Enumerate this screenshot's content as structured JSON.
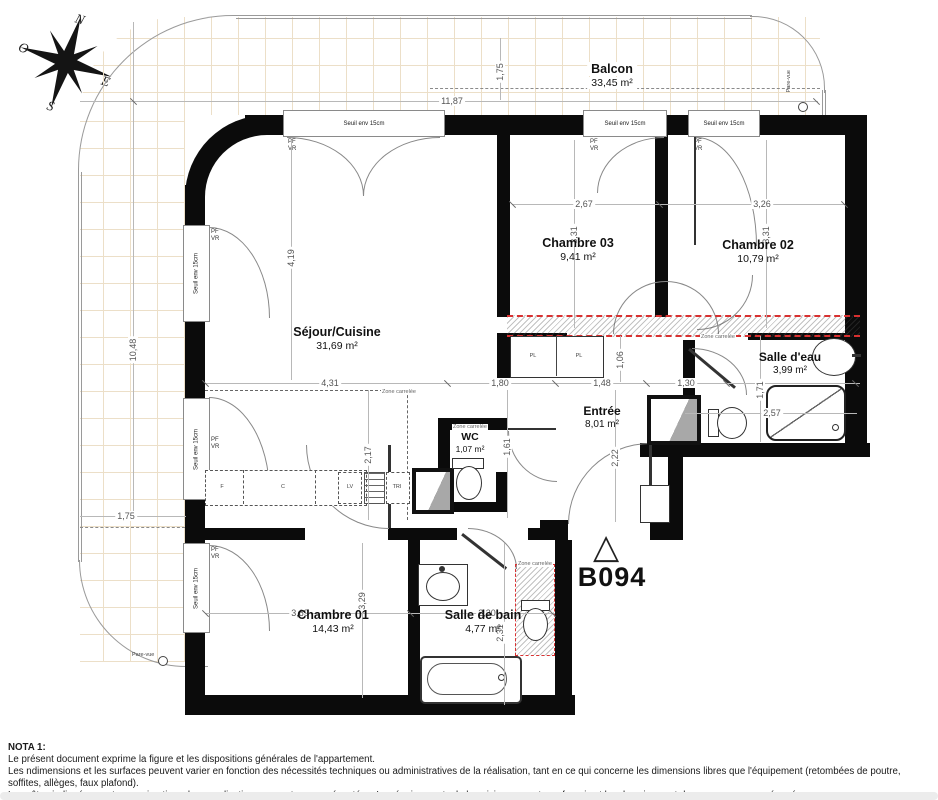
{
  "unit": {
    "code": "B094"
  },
  "compass": {
    "n": "N",
    "e": "E",
    "s": "S",
    "o": "O"
  },
  "rooms": [
    {
      "name": "Balcon",
      "area": "33,45 m²"
    },
    {
      "name": "Séjour/Cuisine",
      "area": "31,69 m²"
    },
    {
      "name": "Chambre 03",
      "area": "9,41 m²"
    },
    {
      "name": "Chambre 02",
      "area": "10,79 m²"
    },
    {
      "name": "Salle d'eau",
      "area": "3,99 m²"
    },
    {
      "name": "Entrée",
      "area": "8,01 m²"
    },
    {
      "name": "WC",
      "area": "1,07 m²"
    },
    {
      "name": "Chambre 01",
      "area": "14,43 m²"
    },
    {
      "name": "Salle de bain",
      "area": "4,77 m²"
    }
  ],
  "dims": {
    "balcony_width": "11,87",
    "balcony_depth": "1,75",
    "left_height": "10,48",
    "left_width": "1,75",
    "sejour_height": "4,19",
    "sejour_width": "4,31",
    "sejour_lower": "2,17",
    "ch03_width": "2,67",
    "ch03_height": "3,31",
    "ch02_width": "3,26",
    "ch02_height": "3,31",
    "hall_a": "1,80",
    "hall_b": "1,48",
    "hall_c": "1,30",
    "hall_d": "1,06",
    "hall_e": "1,61",
    "hall_f": "2,22",
    "sde_height": "1,71",
    "sde_width": "2,57",
    "ch01_width": "3,69",
    "ch01_height": "3,29",
    "sdb_width": "2,30",
    "sdb_height": "2,31"
  },
  "labels": {
    "seuil": "Seuil env 15cm",
    "pf": "PF",
    "vr": "VR",
    "zone": "Zone carrelée",
    "pare_vue": "Pare-vue",
    "pl": "PL",
    "kitchen_f": "F",
    "kitchen_c": "C",
    "kitchen_lv": "LV",
    "kitchen_tri": "TRI"
  },
  "nota": {
    "title": "NOTA 1:",
    "lines": [
      "Le présent document exprime la figure et les dispositions générales de l'appartement.",
      "Les ndimensions et les surfaces peuvent varier en fonction des nécessités techniques ou administratives de la réalisation, tant en ce qui concerne les dimensions libres que l'équipement (retombées de poutre, soffites, allèges, faux plafond).",
      "Les côtes indiquées sont approximatives, les canalisations ne sont pas représentées. Les équipements de la cuisine ne sont pas fournis et les dressing sont des espaces non aménagés.",
      "Les quadrillages dessinés ne sont pas des calepinages. Le gabarits des pièces répondent aux dispositions réglementaires."
    ]
  }
}
